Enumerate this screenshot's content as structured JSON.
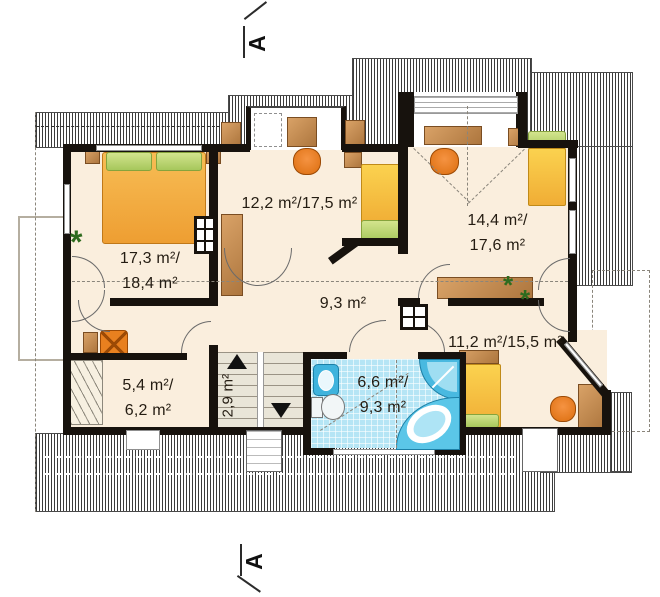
{
  "title": "Attic floor plan",
  "section_markers": {
    "top": "A",
    "bottom": "A"
  },
  "rooms": {
    "bedroom_left": {
      "area": "17,3 m²/",
      "area2": "18,4 m²"
    },
    "room_top_middle": {
      "area": "12,2 m²/17,5 m²"
    },
    "room_right": {
      "area": "14,4 m²/",
      "area2": "17,6 m²"
    },
    "hallway": {
      "area": "9,3 m²"
    },
    "room_bottom_right": {
      "area": "11,2 m²/15,5 m²"
    },
    "wardrobe_room": {
      "area": "5,4 m²/",
      "area2": "6,2 m²"
    },
    "staircase": {
      "area": "2,9 m²"
    },
    "bathroom": {
      "area": "6,6 m²/",
      "area2": "9,3 m²"
    }
  },
  "colors": {
    "floor": "#faeedd",
    "wall": "#17120d",
    "bath_tile": "#b5e5f5",
    "fixture_blue": "#3fb3dd",
    "bed_orange": "#ee9e32",
    "bed_yellow": "#f0ad35",
    "pillow_green": "#a6c75c",
    "furniture_brown": "#c08a55",
    "chair_orange": "#dc6e0f",
    "stairs_grey": "#e9e5d8",
    "plant_green": "#2e6b1e"
  }
}
